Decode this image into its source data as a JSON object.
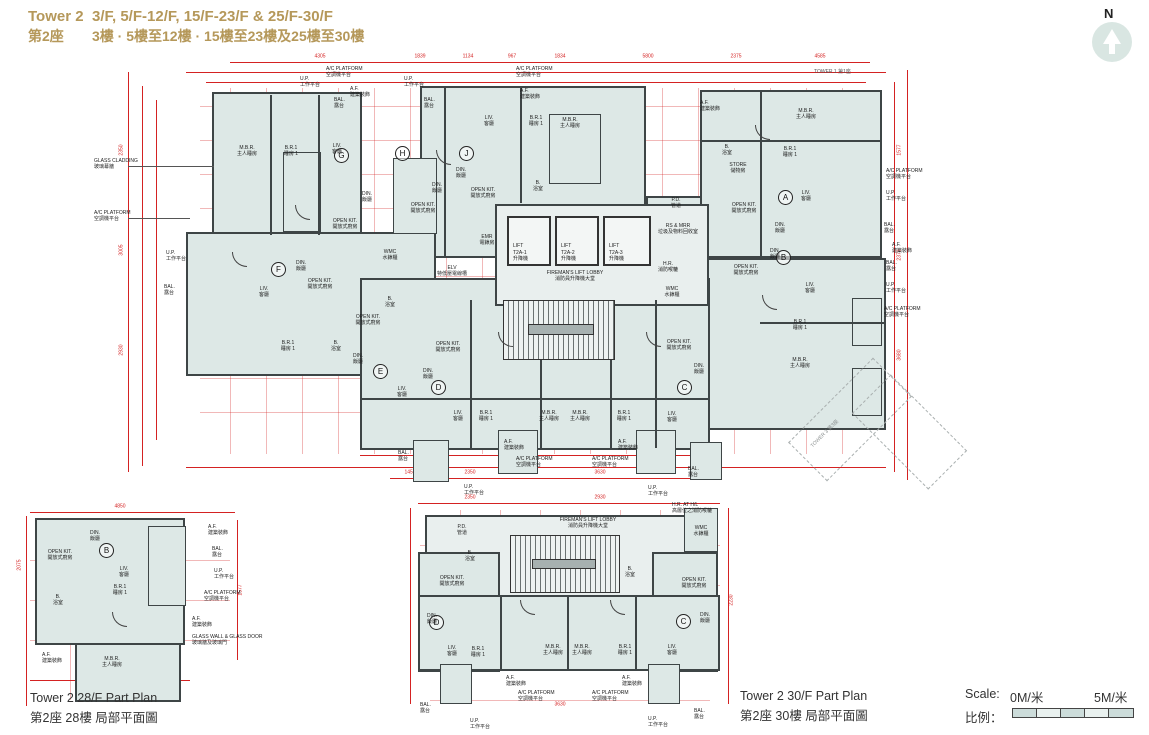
{
  "header": {
    "tower_en": "Tower 2",
    "floors_en": "3/F, 5/F-12/F, 15/F-23/F & 25/F-30/F",
    "tower_zh": "第2座",
    "floors_zh": "3樓 · 5樓至12樓 · 15樓至23樓及25樓至30樓"
  },
  "compass": {
    "n": "N"
  },
  "labels": {
    "mbr": {
      "en": "M.B.R.",
      "zh": "主人睡房"
    },
    "br1": {
      "en": "B.R.1",
      "zh": "睡房 1"
    },
    "liv": {
      "en": "LIV.",
      "zh": "客廳"
    },
    "din": {
      "en": "DIN.",
      "zh": "飯廳"
    },
    "okit": {
      "en": "OPEN KIT.",
      "zh": "開放式廚房"
    },
    "bath": {
      "en": "B.",
      "zh": "浴室"
    },
    "store": {
      "en": "STORE",
      "zh": "儲物房"
    },
    "bal": {
      "en": "BAL.",
      "zh": "露台"
    },
    "up": {
      "en": "U.P.",
      "zh": "工作平台"
    },
    "af": {
      "en": "A.F.",
      "zh": "建築裝飾"
    },
    "acp": {
      "en": "A/C PLATFORM",
      "zh": "空調機平台"
    },
    "glass": {
      "en": "GLASS CLADDING",
      "zh": "玻璃幕牆"
    },
    "glasswall": {
      "en": "GLASS WALL & GLASS DOOR",
      "zh": "玻璃牆及玻璃門"
    },
    "pd": {
      "en": "P.D.",
      "zh": "管道"
    },
    "rsmrr": {
      "en": "RS & MRR",
      "zh": "垃圾及物料回收室"
    },
    "hr": {
      "en": "H.R.",
      "zh": "消防喉轆"
    },
    "hrhl": {
      "en": "H.R. AT H/L",
      "zh": "高層位之消防喉轆"
    },
    "wmc": {
      "en": "WMC",
      "zh": "水錶櫃"
    },
    "emr": {
      "en": "EMR",
      "zh": "電錶房"
    },
    "elv": {
      "en": "ELV",
      "zh": "特低壓電線槽"
    },
    "lobby": {
      "en": "FIREMAN'S LIFT LOBBY",
      "zh": "消防員升降機大堂"
    }
  },
  "lifts": [
    {
      "l1": "LIFT",
      "l2": "T2A-1",
      "zh": "升降機"
    },
    {
      "l1": "LIFT",
      "l2": "T2A-2",
      "zh": "升降機"
    },
    {
      "l1": "LIFT",
      "l2": "T2A-3",
      "zh": "升降機"
    }
  ],
  "units": {
    "main": [
      "A",
      "B",
      "C",
      "D",
      "E",
      "F",
      "G",
      "H",
      "J"
    ],
    "p28": [
      "B"
    ],
    "p30": [
      "D",
      "C"
    ]
  },
  "neighbors": {
    "tower1": "TOWER 1  第1座",
    "tower3": "TOWER 3  第3座"
  },
  "dims": {
    "top": [
      "4305",
      "1839",
      "1134",
      "967",
      "1834",
      "5800",
      "2375",
      "4585"
    ],
    "bottom": [
      "1457",
      "2350",
      "3130",
      "3630",
      "1100",
      "1525"
    ],
    "left": [
      "2350",
      "3005",
      "2930"
    ],
    "right": [
      "1577",
      "2373",
      "3680"
    ],
    "p28": [
      "4850",
      "2075",
      "1577",
      "3025"
    ],
    "p30": [
      "2350",
      "2930",
      "2230",
      "3630"
    ]
  },
  "part28": {
    "title_en": "Tower 2 28/F Part Plan",
    "title_zh": "第2座 28樓 局部平面圖"
  },
  "part30": {
    "title_en": "Tower 2 30/F Part Plan",
    "title_zh": "第2座 30樓 局部平面圖"
  },
  "scale": {
    "en": "Scale:",
    "start": "0M/米",
    "end": "5M/米",
    "zh": "比例："
  },
  "colors": {
    "accent_gold": "#b5985a",
    "dim_red": "#d42222",
    "plan_fill": "#dde8e6",
    "wall": "#3e4546"
  }
}
